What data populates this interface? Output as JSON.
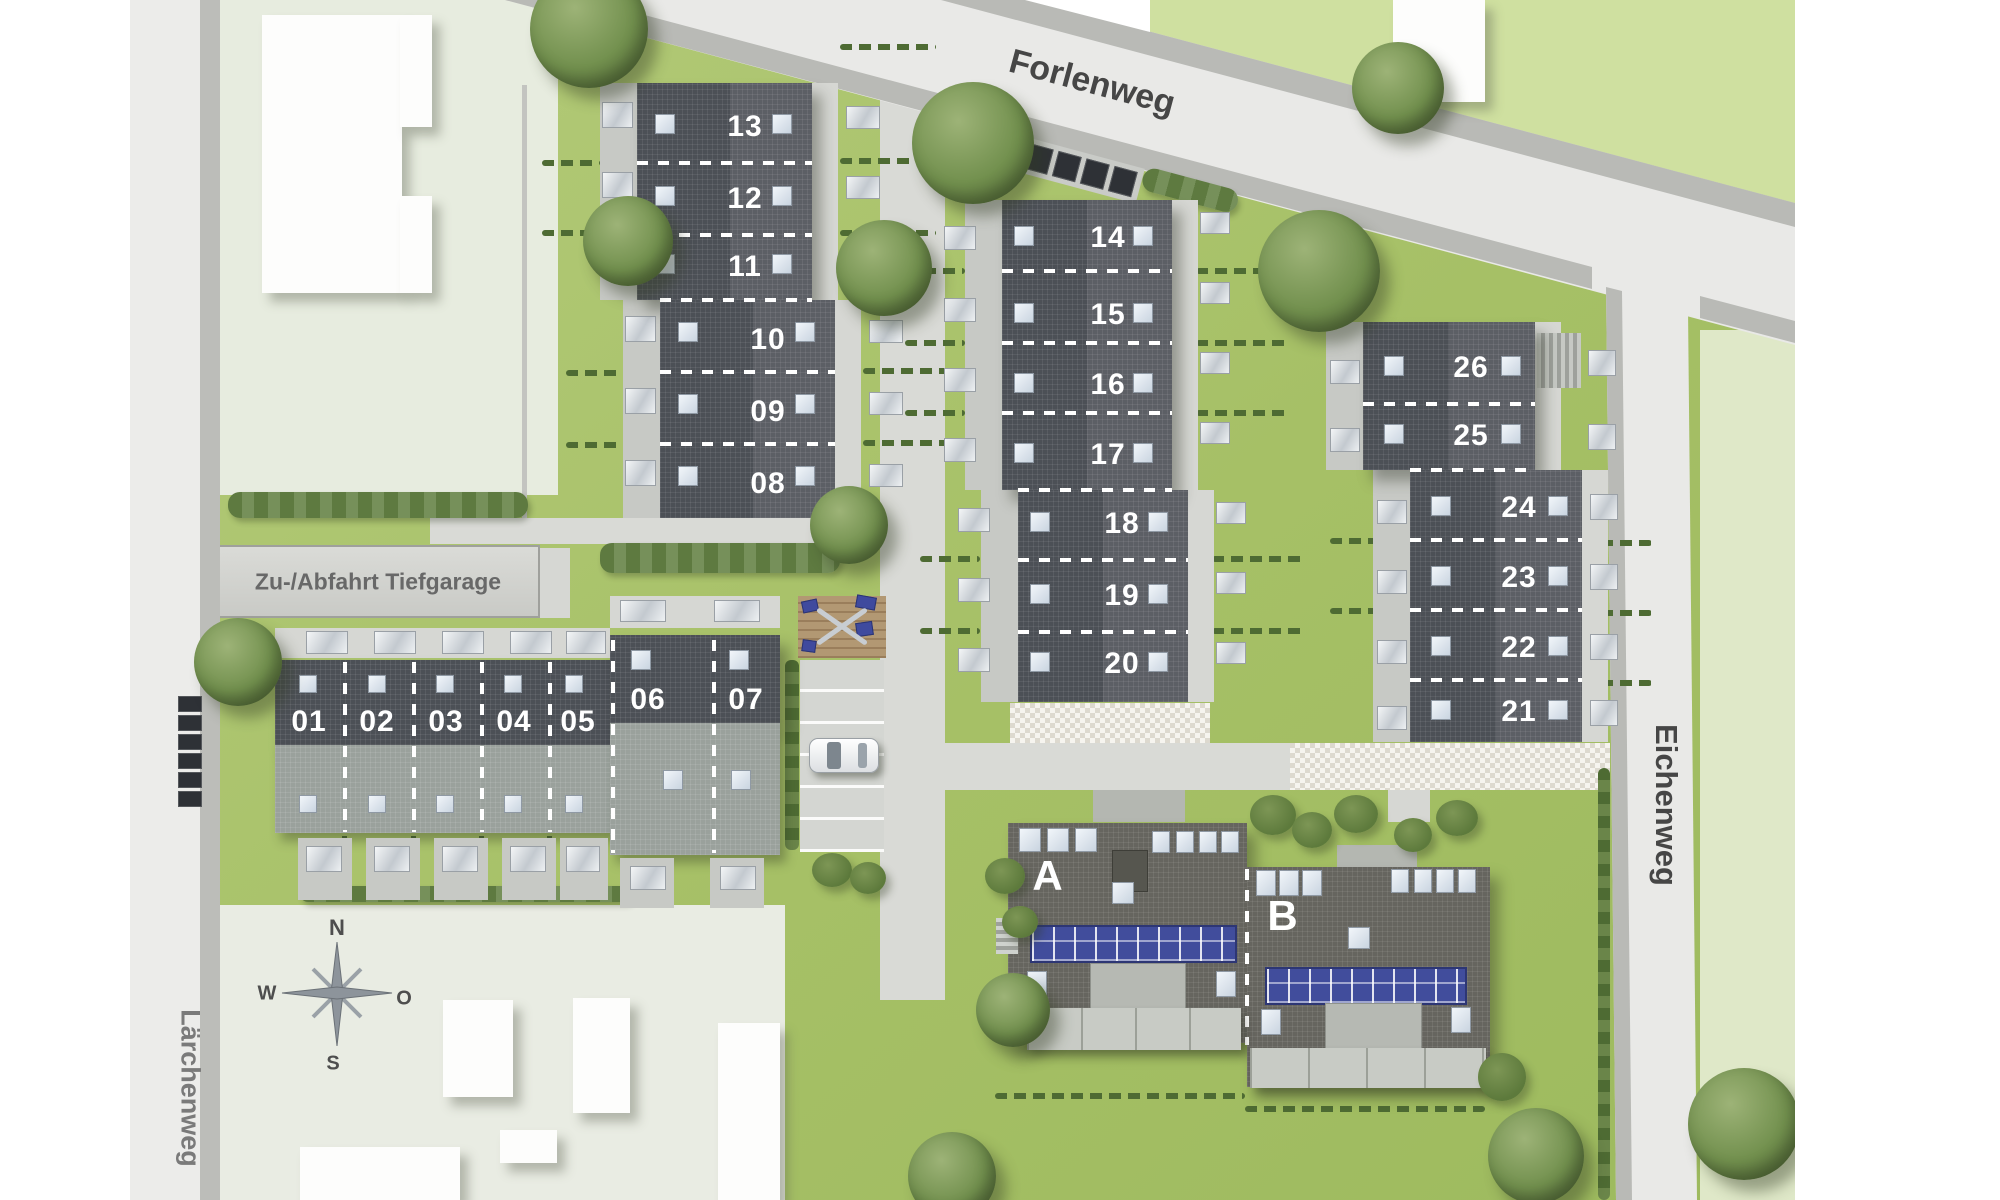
{
  "type": "residential-site-plan",
  "streets": {
    "top": "Forlenweg",
    "right": "Eichenweg",
    "left": "Lärchenweg"
  },
  "annotations": {
    "garage_ramp": "Zu-/Abfahrt Tiefgarage"
  },
  "compass": {
    "north": "N",
    "east": "O",
    "south": "S",
    "west": "W"
  },
  "houses": {
    "block_nw_upper": [
      "13",
      "12",
      "11"
    ],
    "block_nw_lower": [
      "10",
      "09",
      "08"
    ],
    "block_mid_upper": [
      "14",
      "15",
      "16",
      "17"
    ],
    "block_mid_lower": [
      "18",
      "19",
      "20"
    ],
    "block_ne_upper": [
      "26",
      "25"
    ],
    "block_ne_lower": [
      "24",
      "23",
      "22",
      "21"
    ],
    "block_sw_main": [
      "01",
      "02",
      "03",
      "04",
      "05"
    ],
    "block_sw_head": [
      "06",
      "07"
    ],
    "apartment_buildings": [
      "A",
      "B"
    ]
  },
  "colors": {
    "grass": "#aac46d",
    "roof_dark": "#4c5056",
    "roof_light_band": "#9aa19c",
    "street": "#e9e9e7",
    "sidewalk": "#b9bab6",
    "pale_lot_west": "#e7ecdf",
    "pale_lot_east": "#dfe8c8",
    "pale_lot_north": "#cfe0a0",
    "solar_panel_blue": "#414d9c",
    "hedge_green": "#5e7a40",
    "skylight": "#e9eff6",
    "playground_deck": "#b29873",
    "playground_equipment_blue": "#3f4a9e"
  }
}
